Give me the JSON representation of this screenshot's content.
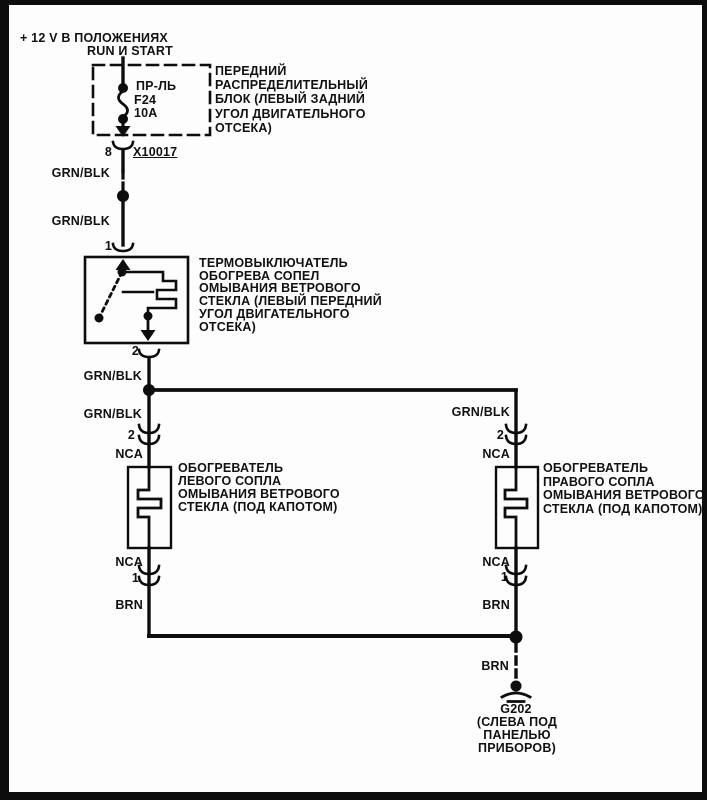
{
  "power": {
    "line1": "+  12 V В ПОЛОЖЕНИЯХ",
    "line2": "RUN И START"
  },
  "fuse": {
    "name": "ПР-ЛЬ",
    "id": "F24",
    "rating": "10A"
  },
  "fuse_block": {
    "lines": [
      "ПЕРЕДНИЙ",
      "РАСПРЕДЕЛИТЕЛЬНЫЙ",
      "БЛОК (ЛЕВЫЙ ЗАДНИЙ",
      "УГОЛ ДВИГАТЕЛЬНОГО",
      "ОТСЕКА)"
    ]
  },
  "connector_x10017": {
    "pin": "8",
    "id": "X10017"
  },
  "thermal_switch": {
    "pin_in": "1",
    "pin_out": "2",
    "lines": [
      "ТЕРМОВЫКЛЮЧАТЕЛЬ",
      "ОБОГРЕВА СОПЕЛ",
      "ОМЫВАНИЯ ВЕТРОВОГО",
      "СТЕКЛА (ЛЕВЫЙ ПЕРЕДНИЙ",
      "УГОЛ ДВИГАТЕЛЬНОГО",
      "ОТСЕКА)"
    ]
  },
  "left_heater": {
    "pin_in": "2",
    "pin_out": "1",
    "lines": [
      "ОБОГРЕВАТЕЛЬ",
      "ЛЕВОГО СОПЛА",
      "ОМЫВАНИЯ ВЕТРОВОГО",
      "СТЕКЛА (ПОД КАПОТОМ)"
    ]
  },
  "right_heater": {
    "pin_in": "2",
    "pin_out": "1",
    "lines": [
      "ОБОГРЕВАТЕЛЬ",
      "ПРАВОГО СОПЛА",
      "ОМЫВАНИЯ ВЕТРОВОГО",
      "СТЕКЛА (ПОД КАПОТОМ)"
    ]
  },
  "wire_colors": {
    "grn_blk": "GRN/BLK",
    "nca": "NCA",
    "brn": "BRN"
  },
  "ground": {
    "id": "G202",
    "lines": [
      "(СЛЕВА ПОД",
      "ПАНЕЛЬЮ",
      "ПРИБОРОВ)"
    ]
  },
  "colors": {
    "ink": "#0d0d0d",
    "paper": "#fdfdfd"
  }
}
